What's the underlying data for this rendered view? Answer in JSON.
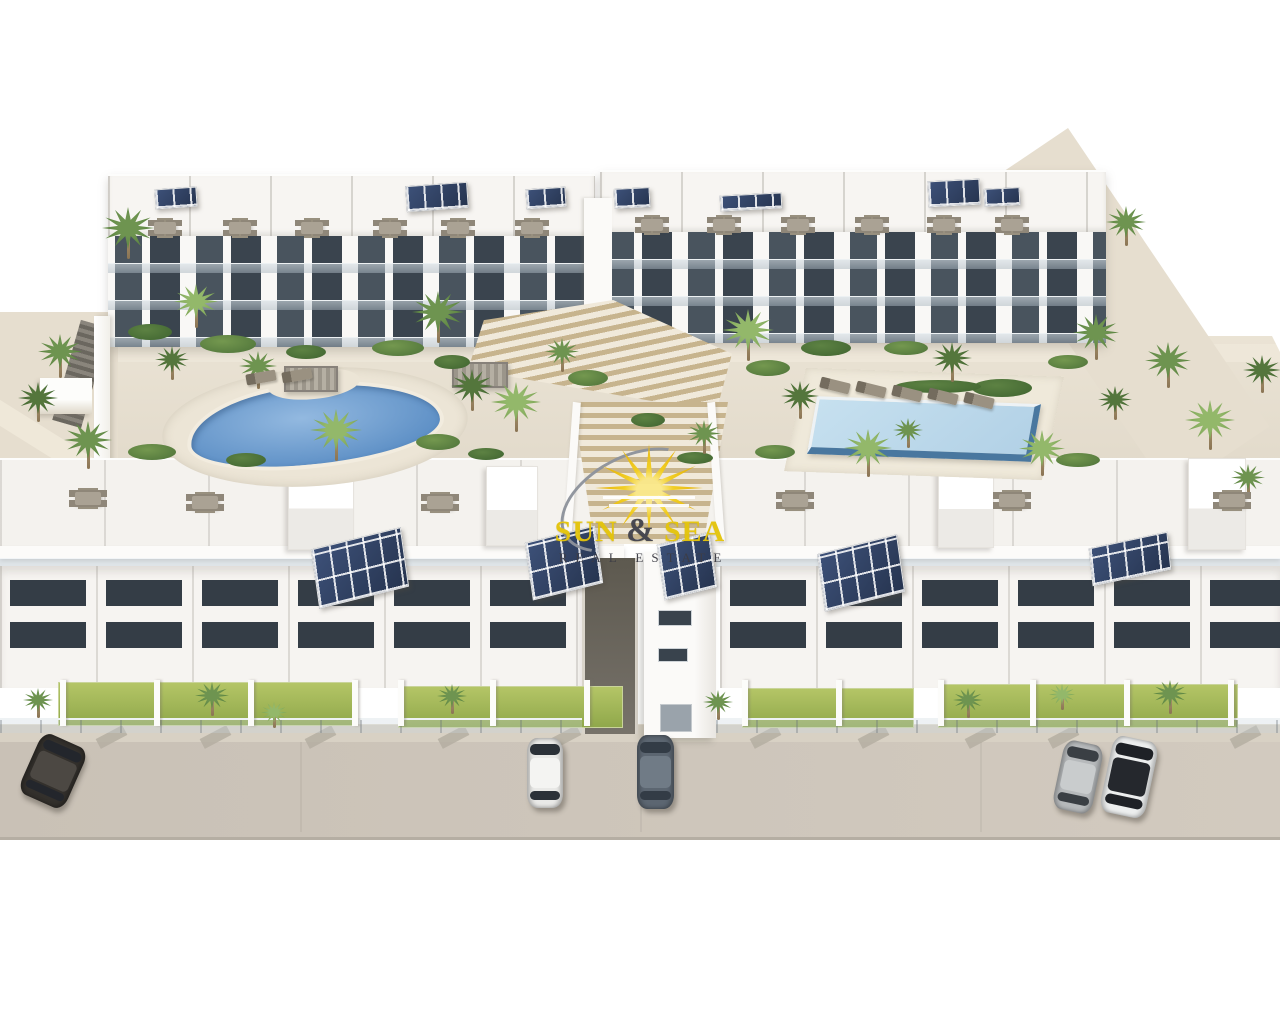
{
  "watermark": {
    "title_left": "SUN",
    "amp": "&",
    "title_right": "SEA",
    "subtitle": "REAL ESTATE"
  },
  "colors": {
    "background": "#ffffff",
    "street": "#cdc5ba",
    "path": "#e6decf",
    "building": "#f7f5f2",
    "window_dark": "#3a444e",
    "lawn": "#9fb954",
    "pool_left_water": "#6d9cd1",
    "pool_right_water": "#bcd8ea",
    "pool_right_wall": "#49779f",
    "solar_panel": "#2d3e62",
    "stairs_wood": "#c7b48e",
    "logo_yellow": "#e4c40b",
    "logo_dark": "#3d3d46"
  },
  "scene": {
    "palms": [
      {
        "x": 128,
        "y": 228,
        "r": 26,
        "t": 1
      },
      {
        "x": 60,
        "y": 352,
        "r": 22,
        "t": 1
      },
      {
        "x": 38,
        "y": 398,
        "r": 20,
        "t": 0
      },
      {
        "x": 88,
        "y": 440,
        "r": 24,
        "t": 1
      },
      {
        "x": 196,
        "y": 302,
        "r": 22,
        "t": 2
      },
      {
        "x": 172,
        "y": 360,
        "r": 17,
        "t": 0
      },
      {
        "x": 258,
        "y": 366,
        "r": 19,
        "t": 1
      },
      {
        "x": 336,
        "y": 430,
        "r": 26,
        "t": 2
      },
      {
        "x": 438,
        "y": 312,
        "r": 26,
        "t": 1
      },
      {
        "x": 472,
        "y": 386,
        "r": 21,
        "t": 0
      },
      {
        "x": 516,
        "y": 402,
        "r": 25,
        "t": 2
      },
      {
        "x": 562,
        "y": 352,
        "r": 17,
        "t": 1
      },
      {
        "x": 748,
        "y": 330,
        "r": 26,
        "t": 2
      },
      {
        "x": 704,
        "y": 434,
        "r": 17,
        "t": 1
      },
      {
        "x": 800,
        "y": 396,
        "r": 19,
        "t": 0
      },
      {
        "x": 868,
        "y": 448,
        "r": 24,
        "t": 2
      },
      {
        "x": 1042,
        "y": 448,
        "r": 23,
        "t": 2
      },
      {
        "x": 952,
        "y": 358,
        "r": 20,
        "t": 0
      },
      {
        "x": 908,
        "y": 430,
        "r": 15,
        "t": 1
      },
      {
        "x": 1096,
        "y": 332,
        "r": 23,
        "t": 1
      },
      {
        "x": 1126,
        "y": 222,
        "r": 20,
        "t": 1
      },
      {
        "x": 1168,
        "y": 360,
        "r": 23,
        "t": 1
      },
      {
        "x": 1210,
        "y": 420,
        "r": 25,
        "t": 2
      },
      {
        "x": 1262,
        "y": 370,
        "r": 19,
        "t": 0
      },
      {
        "x": 1248,
        "y": 478,
        "r": 17,
        "t": 1
      },
      {
        "x": 1115,
        "y": 400,
        "r": 17,
        "t": 0
      },
      {
        "x": 38,
        "y": 700,
        "r": 15,
        "t": 1
      },
      {
        "x": 212,
        "y": 696,
        "r": 17,
        "t": 1
      },
      {
        "x": 274,
        "y": 712,
        "r": 13,
        "t": 2
      },
      {
        "x": 452,
        "y": 696,
        "r": 15,
        "t": 1
      },
      {
        "x": 718,
        "y": 702,
        "r": 15,
        "t": 1
      },
      {
        "x": 968,
        "y": 700,
        "r": 15,
        "t": 1
      },
      {
        "x": 1062,
        "y": 694,
        "r": 13,
        "t": 2
      },
      {
        "x": 1170,
        "y": 694,
        "r": 17,
        "t": 1
      }
    ],
    "bushes": [
      {
        "x": 150,
        "y": 332,
        "w": 44,
        "h": 16,
        "t": 0
      },
      {
        "x": 228,
        "y": 344,
        "w": 56,
        "h": 18,
        "t": 1
      },
      {
        "x": 306,
        "y": 352,
        "w": 40,
        "h": 14,
        "t": 0
      },
      {
        "x": 398,
        "y": 348,
        "w": 52,
        "h": 16,
        "t": 1
      },
      {
        "x": 452,
        "y": 362,
        "w": 36,
        "h": 14,
        "t": 0
      },
      {
        "x": 588,
        "y": 378,
        "w": 40,
        "h": 16,
        "t": 1
      },
      {
        "x": 648,
        "y": 420,
        "w": 34,
        "h": 14,
        "t": 0
      },
      {
        "x": 768,
        "y": 368,
        "w": 44,
        "h": 16,
        "t": 1
      },
      {
        "x": 826,
        "y": 348,
        "w": 50,
        "h": 16,
        "t": 0
      },
      {
        "x": 906,
        "y": 348,
        "w": 44,
        "h": 14,
        "t": 1
      },
      {
        "x": 1002,
        "y": 388,
        "w": 60,
        "h": 18,
        "t": 0
      },
      {
        "x": 1068,
        "y": 362,
        "w": 40,
        "h": 14,
        "t": 1
      },
      {
        "x": 152,
        "y": 452,
        "w": 48,
        "h": 16,
        "t": 1
      },
      {
        "x": 246,
        "y": 460,
        "w": 40,
        "h": 14,
        "t": 0
      },
      {
        "x": 438,
        "y": 442,
        "w": 44,
        "h": 16,
        "t": 1
      },
      {
        "x": 486,
        "y": 454,
        "w": 36,
        "h": 12,
        "t": 0
      },
      {
        "x": 775,
        "y": 452,
        "w": 40,
        "h": 14,
        "t": 1
      },
      {
        "x": 938,
        "y": 386,
        "w": 86,
        "h": 13,
        "t": 0
      },
      {
        "x": 1078,
        "y": 460,
        "w": 44,
        "h": 14,
        "t": 1
      },
      {
        "x": 695,
        "y": 458,
        "w": 36,
        "h": 12,
        "t": 0
      }
    ],
    "solar": [
      {
        "x": 155,
        "y": 188,
        "w": 42,
        "h": 20,
        "rot": -4
      },
      {
        "x": 406,
        "y": 184,
        "w": 62,
        "h": 26,
        "rot": -4
      },
      {
        "x": 526,
        "y": 188,
        "w": 40,
        "h": 20,
        "rot": -4
      },
      {
        "x": 614,
        "y": 188,
        "w": 36,
        "h": 20,
        "rot": -3
      },
      {
        "x": 720,
        "y": 194,
        "w": 62,
        "h": 16,
        "rot": -3
      },
      {
        "x": 928,
        "y": 180,
        "w": 52,
        "h": 26,
        "rot": -3
      },
      {
        "x": 984,
        "y": 188,
        "w": 36,
        "h": 18,
        "rot": -3
      },
      {
        "x": 314,
        "y": 538,
        "w": 92,
        "h": 60,
        "rot": -8,
        "f": 1
      },
      {
        "x": 528,
        "y": 534,
        "w": 72,
        "h": 58,
        "rot": -8,
        "f": 1
      },
      {
        "x": 660,
        "y": 538,
        "w": 54,
        "h": 56,
        "rot": -8,
        "f": 1
      },
      {
        "x": 820,
        "y": 544,
        "w": 82,
        "h": 58,
        "rot": -8,
        "f": 1
      },
      {
        "x": 1090,
        "y": 540,
        "w": 80,
        "h": 38,
        "rot": -6,
        "f": 1
      }
    ],
    "furniture": [
      {
        "x": 165,
        "y": 228
      },
      {
        "x": 240,
        "y": 228
      },
      {
        "x": 312,
        "y": 228
      },
      {
        "x": 390,
        "y": 228
      },
      {
        "x": 458,
        "y": 228
      },
      {
        "x": 532,
        "y": 228
      },
      {
        "x": 652,
        "y": 225
      },
      {
        "x": 724,
        "y": 225
      },
      {
        "x": 798,
        "y": 225
      },
      {
        "x": 872,
        "y": 225
      },
      {
        "x": 944,
        "y": 225
      },
      {
        "x": 1012,
        "y": 225
      },
      {
        "x": 88,
        "y": 498,
        "b": 1
      },
      {
        "x": 205,
        "y": 502,
        "b": 1
      },
      {
        "x": 440,
        "y": 502,
        "b": 1
      },
      {
        "x": 795,
        "y": 500,
        "b": 1
      },
      {
        "x": 1012,
        "y": 500,
        "b": 1
      },
      {
        "x": 1232,
        "y": 500,
        "b": 1
      }
    ],
    "loungers": [
      {
        "x": 820,
        "y": 380,
        "rot": 14
      },
      {
        "x": 856,
        "y": 384,
        "rot": 14
      },
      {
        "x": 892,
        "y": 388,
        "rot": 14
      },
      {
        "x": 928,
        "y": 391,
        "rot": 14
      },
      {
        "x": 964,
        "y": 395,
        "rot": 14
      },
      {
        "x": 246,
        "y": 372,
        "rot": -10
      },
      {
        "x": 282,
        "y": 370,
        "rot": -10
      }
    ],
    "pergolas": [
      {
        "x": 284,
        "y": 366,
        "w": 54,
        "h": 26
      },
      {
        "x": 452,
        "y": 362,
        "w": 56,
        "h": 26
      }
    ],
    "lawns": [
      {
        "x": 58,
        "y": 682,
        "w": 300,
        "h": 44
      },
      {
        "x": 398,
        "y": 686,
        "w": 225,
        "h": 42
      },
      {
        "x": 742,
        "y": 688,
        "w": 172,
        "h": 40
      },
      {
        "x": 938,
        "y": 684,
        "w": 300,
        "h": 44
      }
    ],
    "yard_walls": [
      60,
      154,
      248,
      352,
      398,
      490,
      584,
      742,
      836,
      938,
      1030,
      1124,
      1228
    ],
    "curbs": [
      106,
      210,
      315,
      448,
      560,
      760,
      868,
      975,
      1058,
      1240
    ],
    "seams": [
      300,
      640,
      980
    ],
    "cars": [
      {
        "x": 28,
        "y": 738,
        "w": 50,
        "h": 66,
        "rot": 24,
        "body": "#33302c",
        "roof": "#4c4843",
        "glass": "#23262c"
      },
      {
        "x": 527,
        "y": 738,
        "w": 36,
        "h": 70,
        "rot": 0,
        "body": "#e9e9e7",
        "roof": "#f4f4f2",
        "glass": "#2b3138"
      },
      {
        "x": 637,
        "y": 735,
        "w": 37,
        "h": 74,
        "rot": 0,
        "body": "#5c6671",
        "roof": "#707b86",
        "glass": "#333c46"
      },
      {
        "x": 1058,
        "y": 742,
        "w": 40,
        "h": 70,
        "rot": 12,
        "body": "#b6b9bb",
        "roof": "#c9cccd",
        "glass": "#3a3f44"
      },
      {
        "x": 1106,
        "y": 738,
        "w": 46,
        "h": 78,
        "rot": 12,
        "body": "#eceeee",
        "roof": "#25282d",
        "glass": "#1e2126"
      }
    ]
  }
}
